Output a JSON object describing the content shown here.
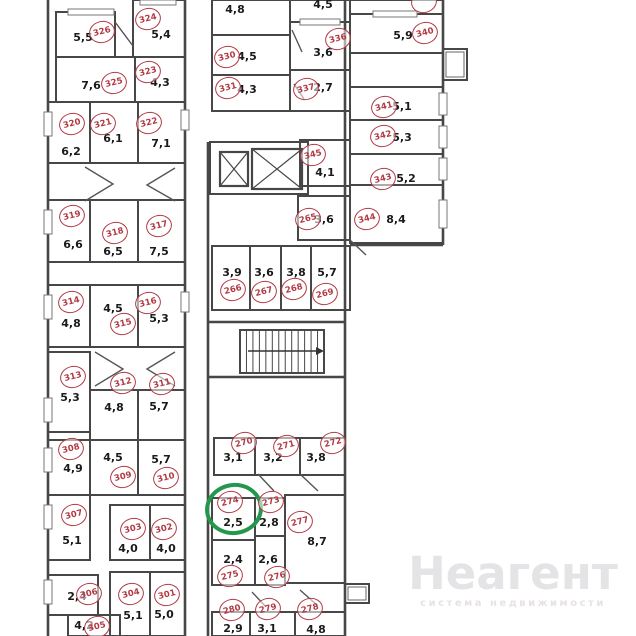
{
  "plan": {
    "wall_color": "#474747",
    "circle_color": "#b13a44",
    "text_color": "#1b1b1b",
    "highlight": {
      "room": "274",
      "color": "#23984d",
      "cx": 234,
      "cy": 509
    }
  },
  "watermark": {
    "title": "Неагент",
    "subtitle": "система недвижимости"
  },
  "rooms": [
    {
      "n": "326",
      "area": "5,5",
      "cx": 102,
      "cy": 32,
      "lx": 83,
      "ly": 37,
      "rect": [
        56,
        12,
        59,
        45
      ]
    },
    {
      "n": "324",
      "area": "5,4",
      "cx": 148,
      "cy": 19,
      "lx": 161,
      "ly": 34,
      "rect": [
        133,
        0,
        52,
        57
      ]
    },
    {
      "n": "325",
      "area": "7,6",
      "cx": 114,
      "cy": 83,
      "lx": 91,
      "ly": 85,
      "rect": [
        56,
        57,
        79,
        45
      ]
    },
    {
      "n": "323",
      "area": "4,3",
      "cx": 148,
      "cy": 72,
      "lx": 160,
      "ly": 82,
      "rect": [
        135,
        57,
        50,
        45
      ]
    },
    {
      "n": "320",
      "area": "6,2",
      "cx": 72,
      "cy": 124,
      "lx": 71,
      "ly": 151,
      "rect": [
        48,
        102,
        42,
        61
      ]
    },
    {
      "n": "321",
      "area": "6,1",
      "cx": 103,
      "cy": 124,
      "lx": 113,
      "ly": 138,
      "rect": [
        90,
        102,
        48,
        61
      ]
    },
    {
      "n": "322",
      "area": "7,1",
      "cx": 149,
      "cy": 123,
      "lx": 161,
      "ly": 143,
      "rect": [
        138,
        102,
        47,
        61
      ]
    },
    {
      "n": "319",
      "area": "6,6",
      "cx": 72,
      "cy": 216,
      "lx": 73,
      "ly": 244,
      "rect": [
        48,
        200,
        42,
        62
      ]
    },
    {
      "n": "318",
      "area": "6,5",
      "cx": 115,
      "cy": 233,
      "lx": 113,
      "ly": 251,
      "rect": [
        90,
        200,
        48,
        62
      ]
    },
    {
      "n": "317",
      "area": "7,5",
      "cx": 159,
      "cy": 226,
      "lx": 159,
      "ly": 251,
      "rect": [
        138,
        200,
        47,
        62
      ]
    },
    {
      "n": "314",
      "area": "4,8",
      "cx": 71,
      "cy": 302,
      "lx": 71,
      "ly": 323,
      "rect": [
        48,
        285,
        42,
        62
      ]
    },
    {
      "n": "315",
      "area": "4,5",
      "cx": 123,
      "cy": 324,
      "lx": 113,
      "ly": 308,
      "rect": [
        90,
        285,
        48,
        62
      ]
    },
    {
      "n": "316",
      "area": "5,3",
      "cx": 148,
      "cy": 303,
      "lx": 159,
      "ly": 318,
      "rect": [
        138,
        285,
        47,
        62
      ]
    },
    {
      "n": "313",
      "area": "5,3",
      "cx": 73,
      "cy": 377,
      "lx": 70,
      "ly": 397,
      "rect": [
        48,
        352,
        42,
        80
      ]
    },
    {
      "n": "312",
      "area": "4,8",
      "cx": 123,
      "cy": 383,
      "lx": 114,
      "ly": 407,
      "rect": [
        90,
        390,
        48,
        50
      ]
    },
    {
      "n": "311",
      "area": "5,7",
      "cx": 162,
      "cy": 384,
      "lx": 159,
      "ly": 406,
      "rect": [
        138,
        390,
        47,
        50
      ]
    },
    {
      "n": "308",
      "area": "4,9",
      "cx": 71,
      "cy": 449,
      "lx": 73,
      "ly": 468,
      "rect": [
        48,
        440,
        42,
        55
      ]
    },
    {
      "n": "309",
      "area": "4,5",
      "cx": 123,
      "cy": 477,
      "lx": 113,
      "ly": 457,
      "rect": [
        90,
        440,
        48,
        55
      ]
    },
    {
      "n": "310",
      "area": "5,7",
      "cx": 166,
      "cy": 478,
      "lx": 161,
      "ly": 459,
      "rect": [
        138,
        440,
        47,
        55
      ]
    },
    {
      "n": "307",
      "area": "5,1",
      "cx": 74,
      "cy": 515,
      "lx": 72,
      "ly": 540,
      "rect": [
        48,
        495,
        42,
        65
      ]
    },
    {
      "n": "303",
      "area": "4,0",
      "cx": 133,
      "cy": 529,
      "lx": 128,
      "ly": 548,
      "rect": [
        110,
        505,
        40,
        55
      ]
    },
    {
      "n": "302",
      "area": "4,0",
      "cx": 164,
      "cy": 529,
      "lx": 166,
      "ly": 548,
      "rect": [
        150,
        505,
        35,
        55
      ]
    },
    {
      "n": "306",
      "area": "2,4",
      "cx": 89,
      "cy": 594,
      "lx": 77,
      "ly": 596,
      "rect": [
        48,
        575,
        50,
        40
      ]
    },
    {
      "n": "304",
      "area": "5,1",
      "cx": 131,
      "cy": 594,
      "lx": 133,
      "ly": 615,
      "rect": [
        110,
        572,
        40,
        64
      ]
    },
    {
      "n": "301",
      "area": "5,0",
      "cx": 167,
      "cy": 595,
      "lx": 164,
      "ly": 614,
      "rect": [
        150,
        572,
        35,
        64
      ]
    },
    {
      "n": "305",
      "area": "4,2",
      "cx": 97,
      "cy": 627,
      "lx": 84,
      "ly": 625,
      "rect": [
        68,
        615,
        52,
        21
      ]
    },
    {
      "n": "330",
      "area": "4,5",
      "cx": 227,
      "cy": 57,
      "lx": 247,
      "ly": 56,
      "rect": [
        212,
        35,
        78,
        40
      ]
    },
    {
      "n": "331",
      "area": "4,3",
      "cx": 228,
      "cy": 88,
      "lx": 247,
      "ly": 89,
      "rect": [
        212,
        75,
        78,
        36
      ]
    },
    {
      "n": "336",
      "area": "3,6",
      "cx": 338,
      "cy": 39,
      "lx": 323,
      "ly": 52,
      "rect": [
        290,
        22,
        60,
        48
      ]
    },
    {
      "n": "337",
      "area": "2,7",
      "cx": 306,
      "cy": 89,
      "lx": 323,
      "ly": 87,
      "rect": [
        290,
        70,
        60,
        41
      ]
    },
    {
      "n": "345",
      "area": "4,1",
      "cx": 313,
      "cy": 155,
      "lx": 325,
      "ly": 172,
      "rect": [
        300,
        140,
        50,
        46
      ]
    },
    {
      "n": "265",
      "area": "3,6",
      "cx": 308,
      "cy": 219,
      "lx": 324,
      "ly": 219,
      "rect": [
        298,
        196,
        52,
        44
      ]
    },
    {
      "n": "266",
      "area": "3,9",
      "cx": 233,
      "cy": 290,
      "lx": 232,
      "ly": 272,
      "rect": [
        212,
        246,
        38,
        64
      ]
    },
    {
      "n": "267",
      "area": "3,6",
      "cx": 264,
      "cy": 292,
      "lx": 264,
      "ly": 272,
      "rect": [
        250,
        246,
        31,
        64
      ]
    },
    {
      "n": "268",
      "area": "3,8",
      "cx": 294,
      "cy": 289,
      "lx": 296,
      "ly": 272,
      "rect": [
        281,
        246,
        30,
        64
      ]
    },
    {
      "n": "269",
      "area": "5,7",
      "cx": 325,
      "cy": 294,
      "lx": 327,
      "ly": 272,
      "rect": [
        311,
        246,
        39,
        64
      ]
    },
    {
      "n": "270",
      "area": "3,1",
      "cx": 244,
      "cy": 443,
      "lx": 233,
      "ly": 457,
      "rect": [
        214,
        438,
        41,
        37
      ]
    },
    {
      "n": "271",
      "area": "3,2",
      "cx": 286,
      "cy": 446,
      "lx": 273,
      "ly": 457,
      "rect": [
        255,
        438,
        45,
        37
      ]
    },
    {
      "n": "272",
      "area": "3,8",
      "cx": 333,
      "cy": 443,
      "lx": 316,
      "ly": 457,
      "rect": [
        300,
        438,
        45,
        37
      ]
    },
    {
      "n": "274",
      "area": "2,5",
      "cx": 230,
      "cy": 502,
      "lx": 233,
      "ly": 522,
      "rect": [
        212,
        498,
        43,
        42
      ]
    },
    {
      "n": "273",
      "area": "2,8",
      "cx": 271,
      "cy": 502,
      "lx": 269,
      "ly": 522,
      "rect": [
        255,
        498,
        30,
        38
      ]
    },
    {
      "n": "277",
      "area": "8,7",
      "cx": 300,
      "cy": 522,
      "lx": 317,
      "ly": 541,
      "rect": [
        285,
        495,
        60,
        88
      ]
    },
    {
      "n": "275",
      "area": "2,4",
      "cx": 230,
      "cy": 576,
      "lx": 233,
      "ly": 559,
      "rect": [
        212,
        540,
        43,
        45
      ]
    },
    {
      "n": "276",
      "area": "2,6",
      "cx": 277,
      "cy": 577,
      "lx": 268,
      "ly": 559,
      "rect": [
        255,
        536,
        30,
        49
      ]
    },
    {
      "n": "280",
      "area": "2,9",
      "cx": 232,
      "cy": 610,
      "lx": 233,
      "ly": 628,
      "rect": [
        212,
        612,
        38,
        24
      ]
    },
    {
      "n": "279",
      "area": "3,1",
      "cx": 268,
      "cy": 609,
      "lx": 267,
      "ly": 628,
      "rect": [
        250,
        612,
        45,
        24
      ]
    },
    {
      "n": "278",
      "area": "4,8",
      "cx": 310,
      "cy": 609,
      "lx": 316,
      "ly": 629,
      "rect": [
        295,
        612,
        50,
        24
      ]
    },
    {
      "n": "340",
      "area": "5,9",
      "cx": 425,
      "cy": 33,
      "lx": 403,
      "ly": 35,
      "rect": [
        350,
        14,
        93,
        39
      ]
    },
    {
      "n": "341",
      "area": "5,1",
      "cx": 384,
      "cy": 107,
      "lx": 402,
      "ly": 106,
      "rect": [
        350,
        87,
        93,
        33
      ]
    },
    {
      "n": "342",
      "area": "5,3",
      "cx": 383,
      "cy": 136,
      "lx": 402,
      "ly": 137,
      "rect": [
        350,
        120,
        93,
        34
      ]
    },
    {
      "n": "343",
      "area": "5,2",
      "cx": 383,
      "cy": 179,
      "lx": 406,
      "ly": 178,
      "rect": [
        350,
        154,
        93,
        31
      ]
    },
    {
      "n": "344",
      "area": "8,4",
      "cx": 367,
      "cy": 219,
      "lx": 396,
      "ly": 219,
      "rect": [
        350,
        185,
        93,
        58
      ]
    }
  ],
  "cut_labels": [
    {
      "area": "4,8",
      "x": 235,
      "y": 9
    },
    {
      "area": "4,5",
      "x": 323,
      "y": 4
    }
  ],
  "cut_circles": [
    {
      "x": 424,
      "y": 2
    }
  ],
  "geometry": {
    "unlabeled_rects": [
      [
        212,
        0,
        78,
        35
      ],
      [
        290,
        0,
        60,
        22
      ],
      [
        350,
        0,
        93,
        14
      ],
      [
        210,
        142,
        98,
        52
      ]
    ],
    "outlines": [
      [
        48,
        0,
        48,
        636
      ],
      [
        185,
        0,
        185,
        636
      ],
      [
        345,
        0,
        345,
        636
      ],
      [
        443,
        0,
        443,
        245
      ],
      [
        350,
        245,
        443,
        245
      ],
      [
        208,
        142,
        208,
        636
      ]
    ],
    "windows": [
      [
        68,
        9,
        46,
        6
      ],
      [
        140,
        0,
        36,
        5
      ],
      [
        373,
        11,
        44,
        6
      ],
      [
        300,
        19,
        40,
        6
      ],
      [
        44,
        112,
        8,
        24
      ],
      [
        44,
        210,
        8,
        24
      ],
      [
        44,
        295,
        8,
        24
      ],
      [
        44,
        398,
        8,
        24
      ],
      [
        44,
        448,
        8,
        24
      ],
      [
        44,
        505,
        8,
        24
      ],
      [
        44,
        580,
        8,
        24
      ],
      [
        181,
        110,
        8,
        20
      ],
      [
        181,
        292,
        8,
        20
      ],
      [
        439,
        93,
        8,
        22
      ],
      [
        439,
        126,
        8,
        22
      ],
      [
        439,
        158,
        8,
        22
      ],
      [
        439,
        200,
        8,
        28
      ]
    ],
    "door_lines": [
      [
        115,
        22,
        133,
        46
      ],
      [
        258,
        474,
        274,
        491
      ],
      [
        300,
        474,
        318,
        491
      ],
      [
        252,
        592,
        266,
        607
      ],
      [
        300,
        590,
        318,
        606
      ],
      [
        292,
        30,
        302,
        52
      ],
      [
        294,
        84,
        304,
        99
      ],
      [
        350,
        240,
        366,
        255
      ]
    ],
    "door_polylines": [
      [
        [
          85,
          167
        ],
        [
          113,
          184
        ],
        [
          85,
          201
        ]
      ],
      [
        [
          175,
          168
        ],
        [
          147,
          185
        ],
        [
          175,
          201
        ]
      ],
      [
        [
          95,
          352
        ],
        [
          123,
          369
        ],
        [
          95,
          386
        ]
      ],
      [
        [
          175,
          352
        ],
        [
          147,
          369
        ],
        [
          175,
          386
        ]
      ]
    ],
    "stairs": {
      "enclosure": [
        [
          208,
          322,
          345,
          322
        ],
        [
          208,
          377,
          345,
          377
        ]
      ],
      "box": [
        240,
        330,
        84,
        43
      ],
      "step_count": 13,
      "arrow": [
        248,
        351,
        316,
        351
      ]
    },
    "elevators": [
      [
        220,
        152,
        28,
        34
      ],
      [
        252,
        149,
        50,
        40
      ]
    ],
    "balconies": [
      [
        443,
        49,
        24,
        31
      ],
      [
        345,
        584,
        24,
        19
      ]
    ]
  }
}
